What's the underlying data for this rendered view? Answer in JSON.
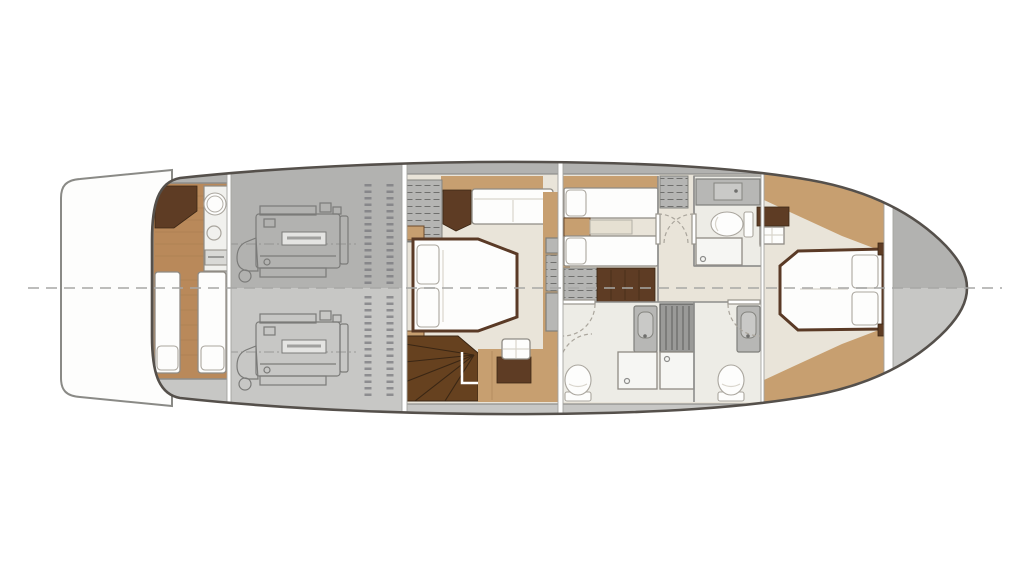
{
  "colors": {
    "page_bg": "#ffffff",
    "hull_outline": "#55504b",
    "deck": "#c7c7c5",
    "deck_dark": "#b2b2b0",
    "platform_white": "#fdfdfc",
    "platform_outline": "#8a8a86",
    "cream": "#e9e4d9",
    "bath_floor": "#edece6",
    "wood": "#b9895a",
    "wood_tan": "#c79f70",
    "wood_dark": "#5e3c24",
    "wood_stair": "#66411f",
    "white_furniture": "#fdfdfc",
    "furniture_outline": "#8f8b84",
    "fixture_gray": "#b7b7b5",
    "fixture_dark": "#9a9a98",
    "wall": "#8d8d8b",
    "door_arc": "#aaa59c",
    "centerline": "#a8a8a6",
    "engine_line": "#7b7b79",
    "label_fill": "#e4e4e2"
  },
  "diagram": {
    "type": "yacht-lower-deck-floor-plan",
    "orientation": "bow-right-stern-left",
    "areas": [
      {
        "name": "swim-platform",
        "fixtures": []
      },
      {
        "name": "crew-cabin",
        "fixtures": [
          "corner-cabinet",
          "galley-counter",
          "sink",
          "cooktop",
          "stove",
          "locker",
          "berth-port",
          "berth-starboard"
        ]
      },
      {
        "name": "engine-room",
        "fixtures": [
          "engine-port",
          "engine-starboard",
          "tank-port",
          "tank-starboard"
        ]
      },
      {
        "name": "master-cabin",
        "fixtures": [
          "wardrobe",
          "corner-cabinet",
          "sofa",
          "double-bed",
          "nightstand-aft",
          "nightstand-fwd",
          "staircase",
          "ottoman",
          "floor-cabinet",
          "side-lockers"
        ]
      },
      {
        "name": "twin-cabin",
        "fixtures": [
          "single-bed-port",
          "single-bed-starboard",
          "nightstand",
          "locker",
          "wardrobe"
        ]
      },
      {
        "name": "forward-head",
        "fixtures": [
          "vanity",
          "toilet",
          "shower"
        ]
      },
      {
        "name": "port-bathroom",
        "fixtures": [
          "vanity",
          "shower",
          "toilet"
        ]
      },
      {
        "name": "starboard-bathroom",
        "fixtures": [
          "vanity",
          "shower",
          "toilet"
        ]
      },
      {
        "name": "hall-closet",
        "fixtures": [
          "louvered-cabinet"
        ]
      },
      {
        "name": "vip-cabin",
        "fixtures": [
          "double-bed",
          "cabinet",
          "side-table"
        ]
      },
      {
        "name": "bow-locker",
        "fixtures": []
      }
    ]
  }
}
